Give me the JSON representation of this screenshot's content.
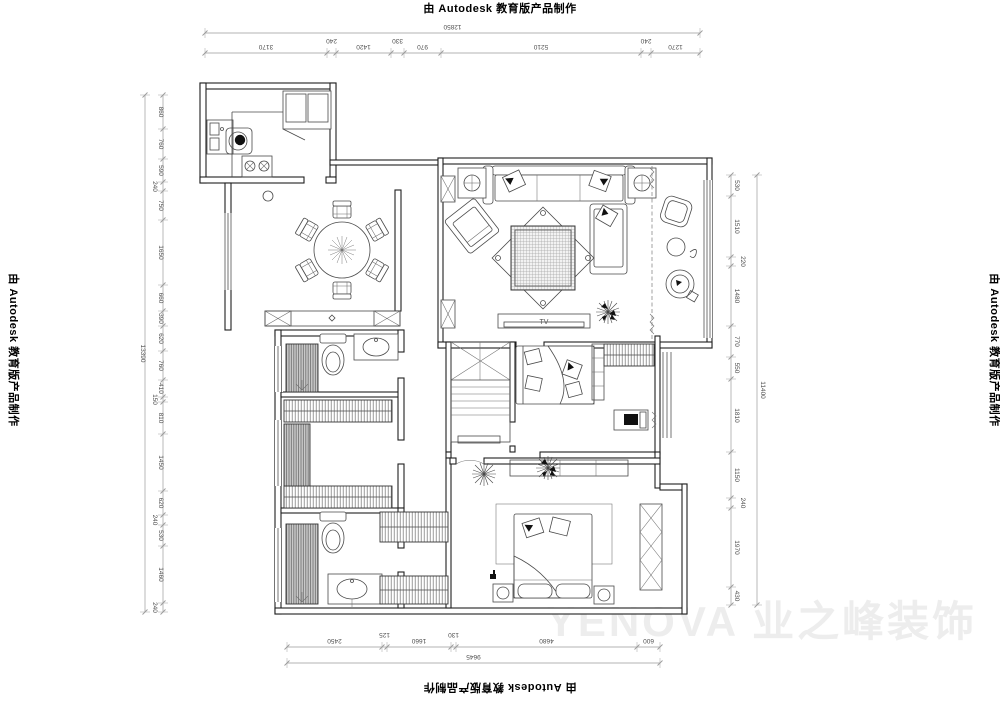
{
  "watermarks": {
    "autodesk": "由 Autodesk 教育版产品制作",
    "company": "YENOVA 业之峰装饰"
  },
  "labels": {
    "tv": "TV"
  },
  "colors": {
    "plan_line": "#1f1f1f",
    "dimension_line": "#9a9a9a",
    "dimension_text": "#4f4f4f",
    "faint_watermark": "#ededed"
  },
  "dimensions": {
    "top": {
      "overall": "12850",
      "segments": [
        "3170",
        "240",
        "1420",
        "330",
        "970",
        "5210",
        "240",
        "1270"
      ]
    },
    "bottom": {
      "overall": "9645",
      "segments": [
        "2450",
        "125",
        "1660",
        "130",
        "4680",
        "600"
      ]
    },
    "left": {
      "overall": "13390",
      "segments": [
        "860",
        "760",
        "590",
        "240",
        "750",
        "1650",
        "660",
        "390",
        "620",
        "760",
        "410",
        "150",
        "810",
        "1450",
        "620",
        "240",
        "530",
        "1460",
        "240"
      ]
    },
    "right": {
      "overall": "11400",
      "segments": [
        "530",
        "1510",
        "220",
        "1480",
        "770",
        "550",
        "1810",
        "1150",
        "240",
        "1970",
        "430"
      ]
    }
  }
}
